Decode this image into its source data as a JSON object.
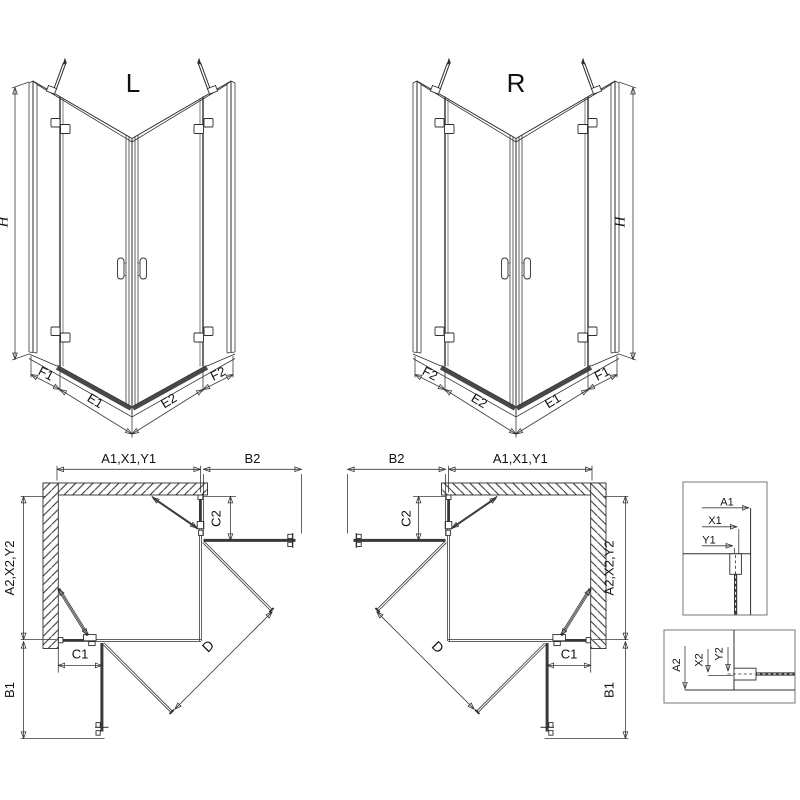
{
  "colors": {
    "line": "#2e2e2e",
    "dim": "#3a3a3a",
    "tray": "#484848",
    "wall_hatch": "#666666",
    "box": "#777777",
    "text": "#111111",
    "bg": "#ffffff"
  },
  "iso_left": {
    "title": "L",
    "height": "H",
    "fixed_left": "F1",
    "door_left": "E1",
    "door_right": "E2",
    "fixed_right": "F2"
  },
  "iso_right": {
    "title": "R",
    "height": "H",
    "fixed_left": "F2",
    "door_left": "E2",
    "door_right": "E1",
    "fixed_right": "F1"
  },
  "plan_left": {
    "width_top": "A1,X1,Y1",
    "door_b2": "B2",
    "hinge_c2": "C2",
    "depth_left": "A2,X2,Y2",
    "hinge_c1": "C1",
    "door_b1": "B1",
    "diagonal": "D"
  },
  "plan_right": {
    "width_top": "A1,X1,Y1",
    "door_b2": "B2",
    "hinge_c2": "C2",
    "depth_right": "A2,X2,Y2",
    "hinge_c1": "C1",
    "door_b1": "B1",
    "diagonal": "D"
  },
  "detail_top": {
    "a1": "A1",
    "x1": "X1",
    "y1": "Y1"
  },
  "detail_bottom": {
    "a2": "A2",
    "x2": "X2",
    "y2": "Y2"
  }
}
